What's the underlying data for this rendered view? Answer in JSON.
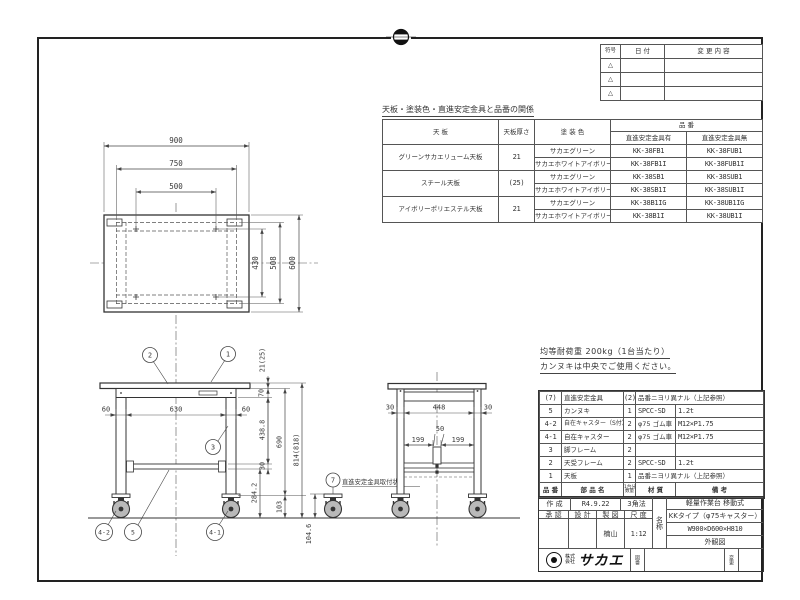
{
  "revision_table": {
    "col_mark": "符号",
    "col_date": "日 付",
    "col_desc": "変 更 内 容",
    "rows": [
      {
        "mark": "△"
      },
      {
        "mark": "△"
      },
      {
        "mark": "△"
      }
    ]
  },
  "relation_table": {
    "title": "天板・塗装色・直進安定金具と品番の関係",
    "col_top": "天 板",
    "col_thickness": "天板厚さ",
    "col_color": "塗 装 色",
    "col_hinban": "品 番",
    "col_with": "直進安定金具有",
    "col_without": "直進安定金具無",
    "groups": [
      {
        "top": "グリーンサカエリューム天板",
        "thickness": "21",
        "rows": [
          {
            "color": "サカエグリーン",
            "with": "KK-38FB1",
            "without": "KK-38FUB1"
          },
          {
            "color": "サカエホワイトアイボリー",
            "with": "KK-38FB1I",
            "without": "KK-38FUB1I"
          }
        ]
      },
      {
        "top": "スチール天板",
        "thickness": "(25)",
        "rows": [
          {
            "color": "サカエグリーン",
            "with": "KK-38SB1",
            "without": "KK-38SUB1"
          },
          {
            "color": "サカエホワイトアイボリー",
            "with": "KK-38SB1I",
            "without": "KK-38SUB1I"
          }
        ]
      },
      {
        "top": "アイボリーポリエステル天板",
        "thickness": "21",
        "rows": [
          {
            "color": "サカエグリーン",
            "with": "KK-38B1IG",
            "without": "KK-38UB1IG"
          },
          {
            "color": "サカエホワイトアイボリー",
            "with": "KK-38B1I",
            "without": "KK-38UB1I"
          }
        ]
      }
    ]
  },
  "notes": {
    "line1": "均等耐荷重 200kg（1台当たり）",
    "line2": "カンヌキは中央でご使用ください。"
  },
  "parts_list": {
    "col_no": "品 番",
    "col_name": "部 品 名",
    "col_qty_top": "1台分",
    "col_qty_bottom": "数量",
    "col_material": "材 質",
    "col_remarks": "備 考",
    "rows": [
      {
        "no": "(7)",
        "name": "直進安定金具",
        "qty": "(2)",
        "material": "品番ニヨリ異ナル（上記参照）",
        "remarks": ""
      },
      {
        "no": "5",
        "name": "カンヌキ",
        "qty": "1",
        "material": "SPCC-SD",
        "remarks": "1.2t"
      },
      {
        "no": "4-2",
        "name": "自在キャスター（S付）",
        "qty": "2",
        "material": "φ75 ゴム車",
        "remarks": "M12×P1.75"
      },
      {
        "no": "4-1",
        "name": "自在キャスター",
        "qty": "2",
        "material": "φ75 ゴム車",
        "remarks": "M12×P1.75"
      },
      {
        "no": "3",
        "name": "脚フレーム",
        "qty": "2",
        "material": "",
        "remarks": ""
      },
      {
        "no": "2",
        "name": "天受フレーム",
        "qty": "2",
        "material": "SPCC-SD",
        "remarks": "1.2t"
      },
      {
        "no": "1",
        "name": "天板",
        "qty": "1",
        "material": "品番ニヨリ異ナル（上記参照）",
        "remarks": ""
      }
    ]
  },
  "title_block": {
    "created_label": "作 成",
    "created_value": "R4.9.22",
    "projection": "3角法",
    "approve_label": "承 認",
    "design_label": "設 計",
    "draft_label": "製 図",
    "scale_label": "尺 度",
    "approve_value": "",
    "design_value": "",
    "draft_value": "楠山",
    "scale_value": "1:12",
    "name_label": "名称",
    "name_line1": "軽量作業台 移動式",
    "name_line2": "KKタイプ（φ75キャスター）",
    "name_line3": "W900×D600×H810",
    "name_line4": "外観図",
    "company_prefix": "株式会社",
    "company_name": "サカエ",
    "drawing_no_label": "図番",
    "change_label": "変更"
  },
  "plan_view": {
    "dim_width": "900",
    "dim_leg_span": "750",
    "dim_hole_span": "500",
    "dim_hole_depth": "430",
    "dim_leg_depth": "508",
    "dim_depth": "600"
  },
  "front_view": {
    "dim_leg_left": "60",
    "dim_inner": "630",
    "dim_leg_right": "60",
    "dim_top_thickness": "21(25)",
    "dim_apron": "70",
    "dim_mid": "438.8",
    "dim_leg_height": "690",
    "dim_total_height": "814(818)",
    "dim_shelf": "30",
    "dim_shelf_floor": "284.2",
    "dim_foot": "103",
    "dim_caster_height": "104.6",
    "callout_plate2": "2",
    "callout_top": "1",
    "callout_leg": "3",
    "callout_caster_s": "4-2",
    "callout_shelf": "5",
    "callout_caster": "4-1",
    "callout_bracket": "7",
    "bracket_note": "直進安定金具取付状態"
  },
  "side_view": {
    "dim_leg_front": "30",
    "dim_inner": "448",
    "dim_leg_back": "30",
    "dim_bracket": "50",
    "dim_199_left": "199",
    "dim_199_right": "199"
  }
}
